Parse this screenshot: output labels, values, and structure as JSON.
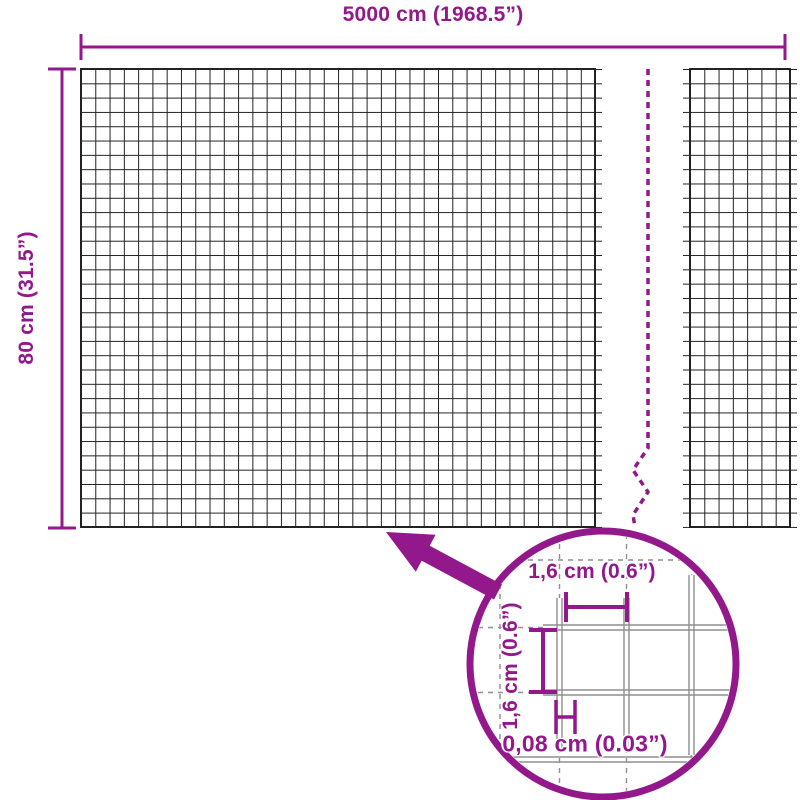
{
  "overall_dimensions": {
    "width_label": "5000 cm (1968.5”)",
    "height_label": "80 cm (31.5”)"
  },
  "detail_view": {
    "cell_width_label": "1,6 cm (0.6”)",
    "cell_height_label": "1,6 cm (0.6”)",
    "wire_thickness_label": "0,08 cm (0.03”)"
  },
  "colors": {
    "accent": "#93188C",
    "mesh_line": "#222222",
    "detail_wire": "#8F8F8F",
    "background": "#FFFFFF"
  }
}
